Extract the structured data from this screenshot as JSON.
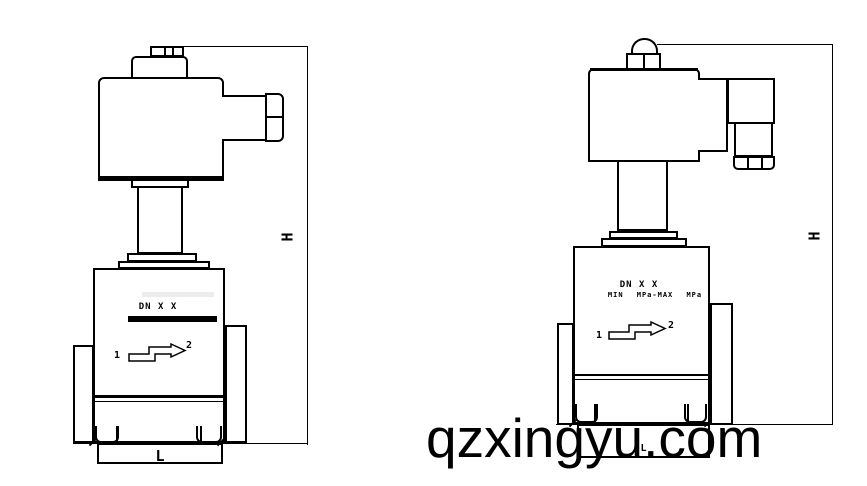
{
  "canvas": {
    "width": 867,
    "height": 486,
    "background": "#ffffff",
    "line_color": "#000000"
  },
  "watermark": {
    "text": "qzxingyu.com",
    "color": "#000000"
  },
  "icons": {
    "flow_arrow": "stepped-arrow-right"
  },
  "left_valve": {
    "dn_label": "DN X X",
    "port_in": "1",
    "port_out": "2",
    "height_dim_label": "H",
    "length_dim_label": "L"
  },
  "right_valve": {
    "dn_label": "DN X X",
    "pressure_label": "MIN MPa-MAX MPa",
    "port_in": "1",
    "port_out": "2",
    "height_dim_label": "H",
    "length_dim_label": "L"
  }
}
